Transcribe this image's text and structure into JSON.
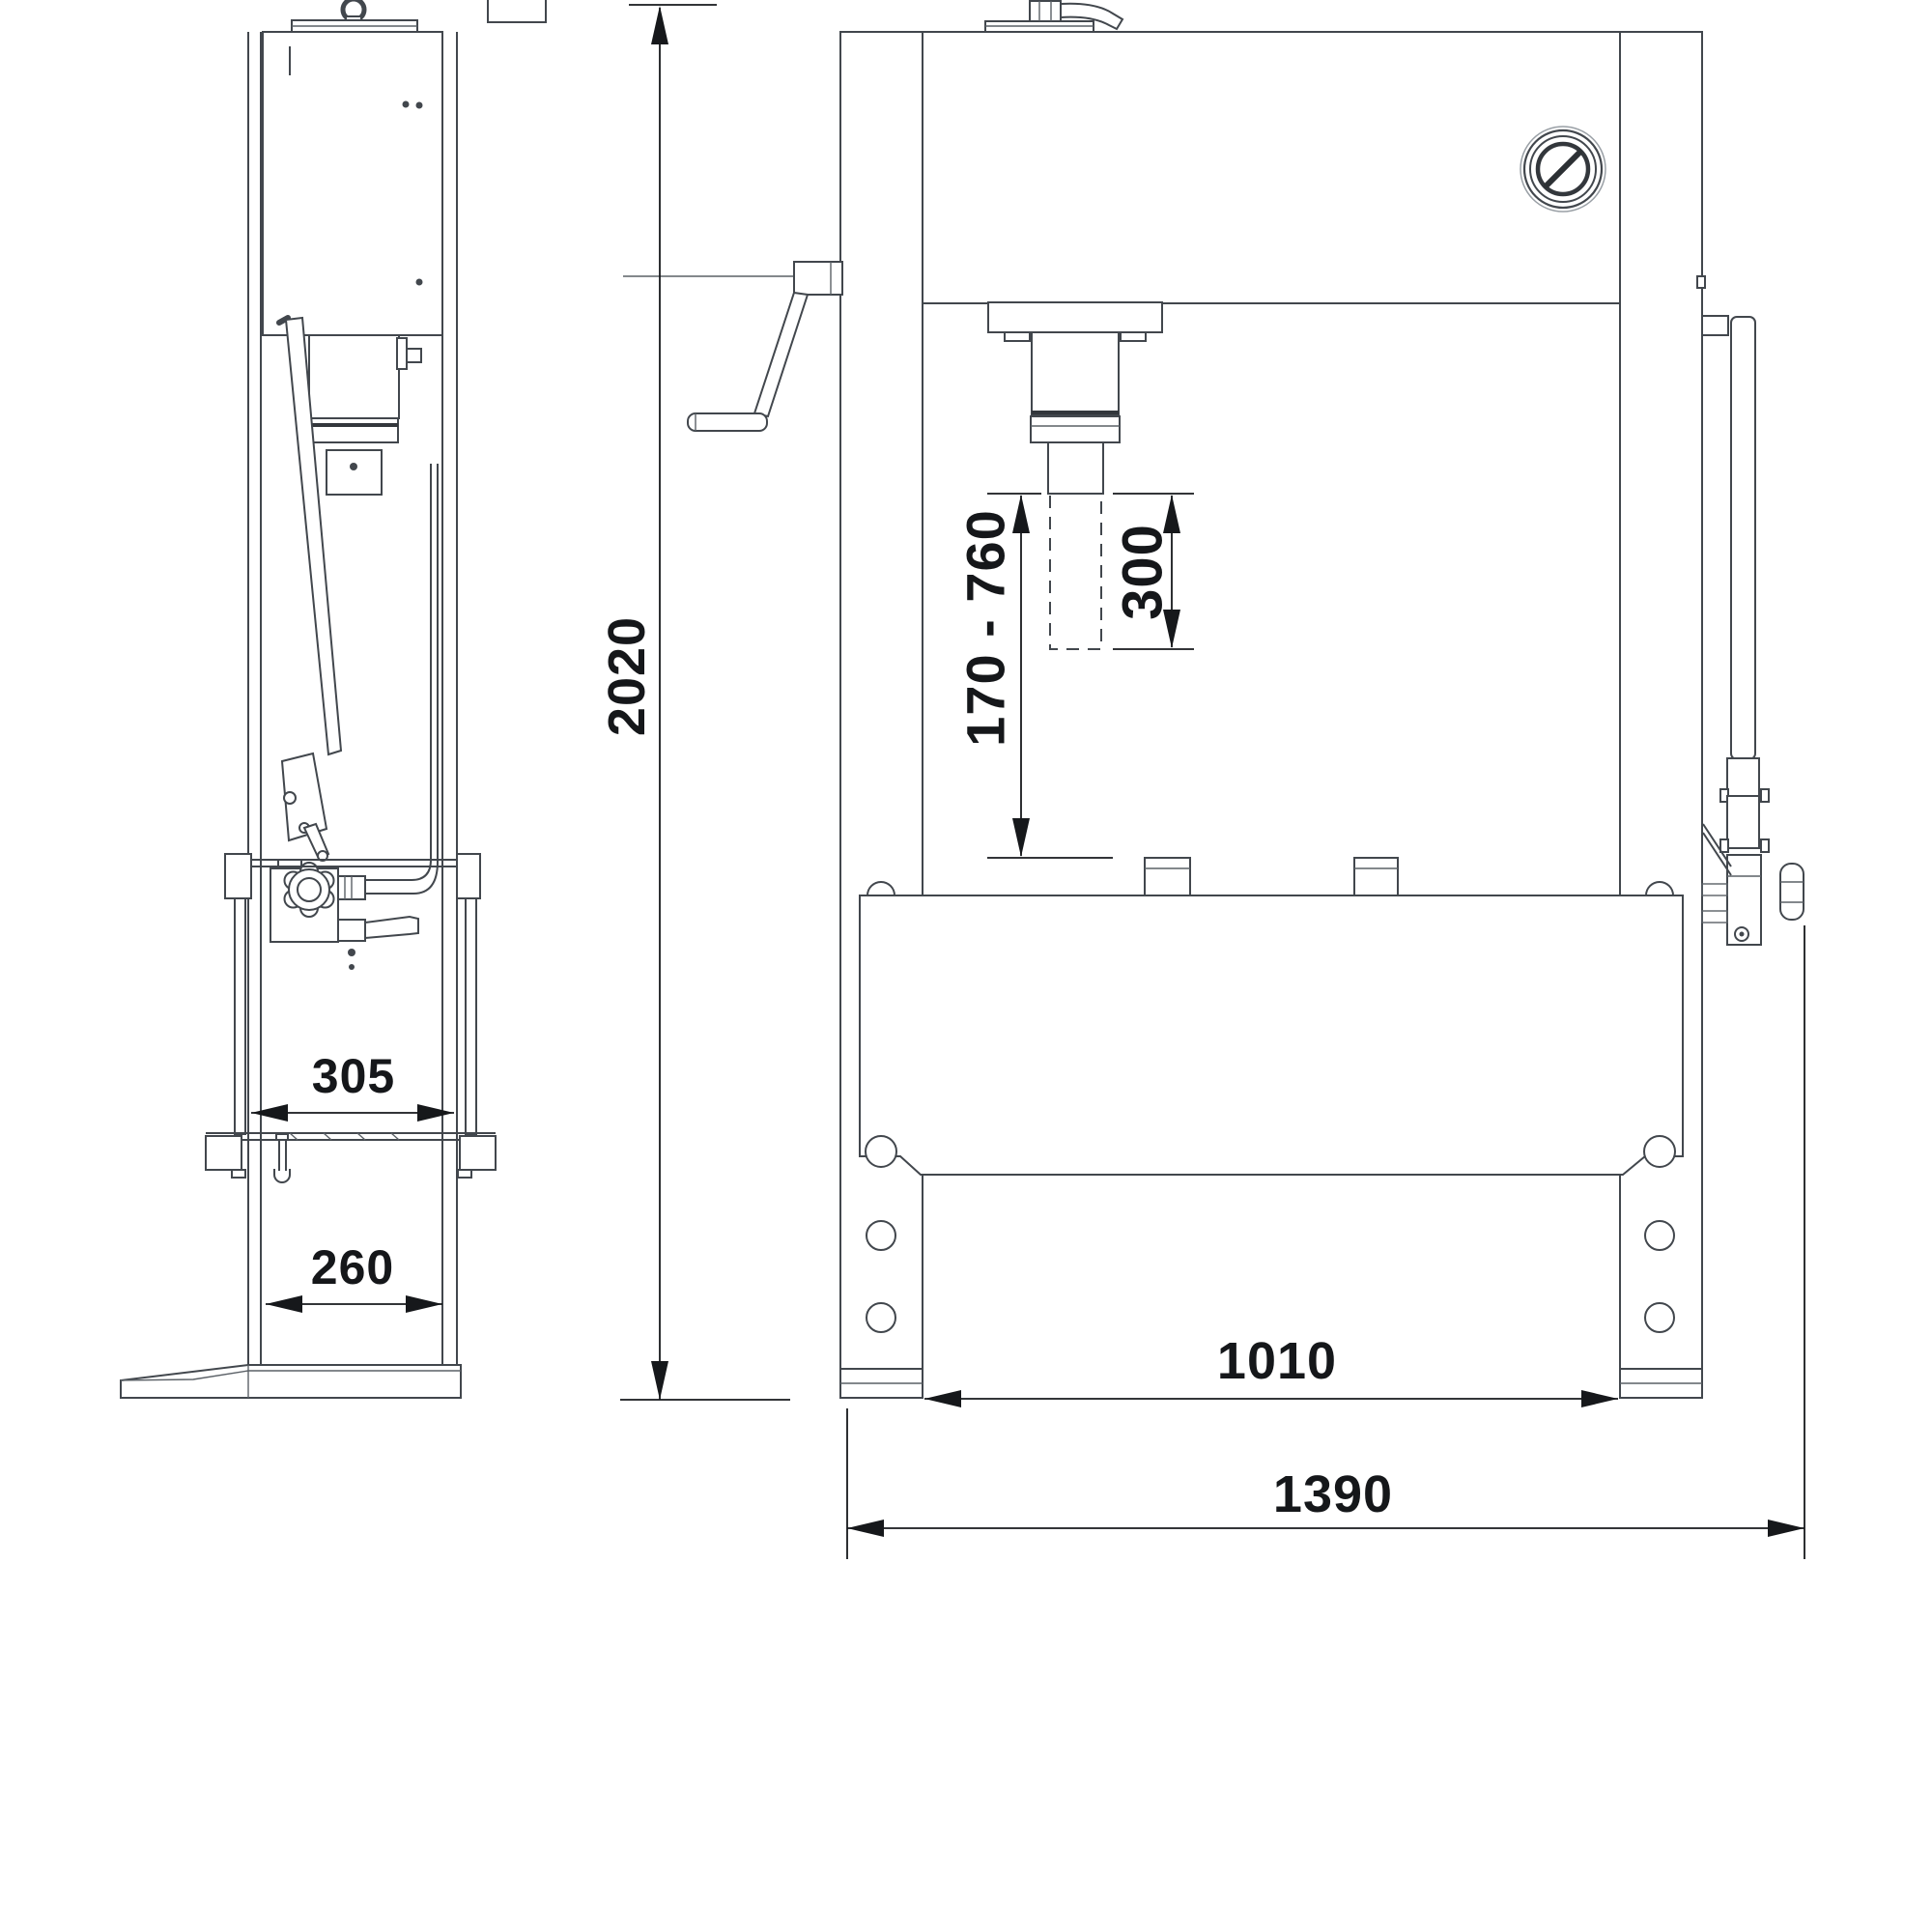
{
  "drawing": {
    "dimensions": {
      "overall_height_mm": "2020",
      "side_width_upper_mm": "305",
      "side_width_lower_mm": "260",
      "working_range_mm": "170 - 760",
      "piston_stroke_mm": "300",
      "inner_width_mm": "1010",
      "overall_width_mm": "1390"
    }
  }
}
